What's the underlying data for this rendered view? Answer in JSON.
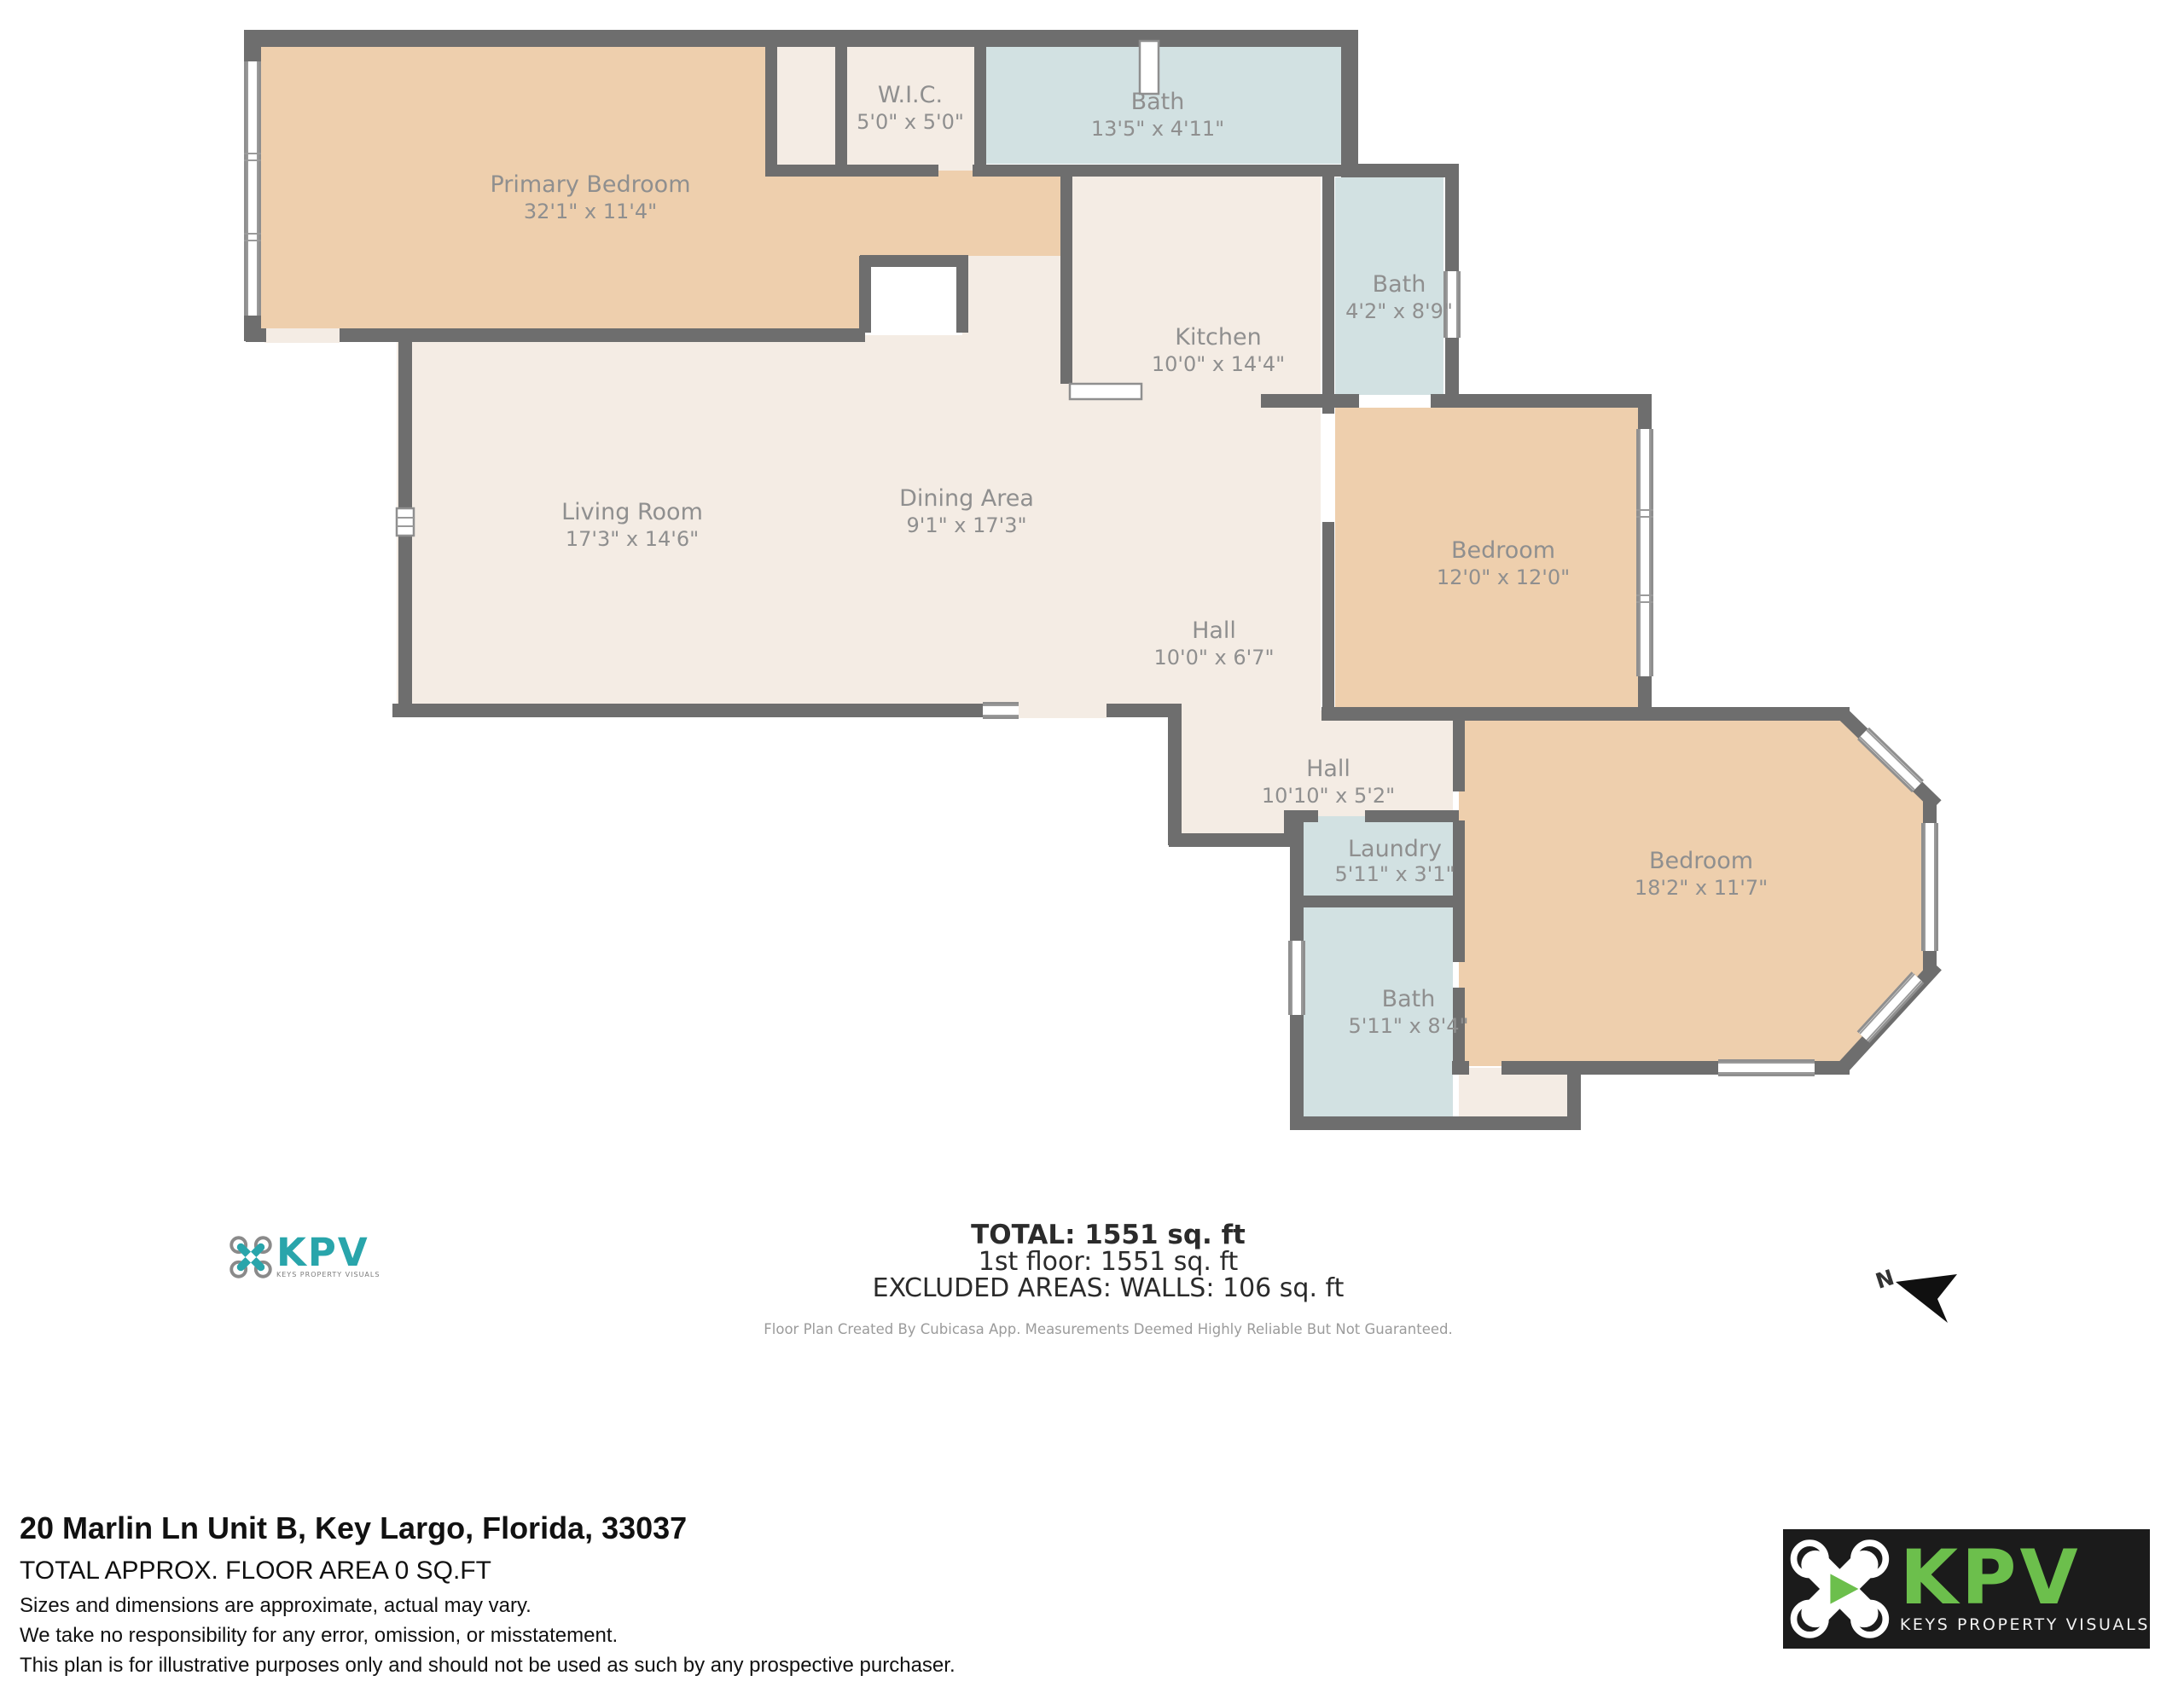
{
  "plan": {
    "rooms": [
      {
        "name": "Primary Bedroom",
        "dims": "32'1\" x 11'4\""
      },
      {
        "name": "W.I.C.",
        "dims": "5'0\" x 5'0\""
      },
      {
        "name": "Bath",
        "dims": "13'5\" x 4'11\""
      },
      {
        "name": "Bath",
        "dims": "4'2\" x 8'9\""
      },
      {
        "name": "Kitchen",
        "dims": "10'0\" x 14'4\""
      },
      {
        "name": "Dining Area",
        "dims": "9'1\" x 17'3\""
      },
      {
        "name": "Living Room",
        "dims": "17'3\" x 14'6\""
      },
      {
        "name": "Hall",
        "dims": "10'0\" x 6'7\""
      },
      {
        "name": "Bedroom",
        "dims": "12'0\" x 12'0\""
      },
      {
        "name": "Hall",
        "dims": "10'10\" x 5'2\""
      },
      {
        "name": "Laundry",
        "dims": "5'11\" x 3'1\""
      },
      {
        "name": "Bedroom",
        "dims": "18'2\" x 11'7\""
      },
      {
        "name": "Bath",
        "dims": "5'11\" x 8'4\""
      }
    ],
    "summary": {
      "total": "TOTAL: 1551 sq. ft",
      "floor": "1st floor: 1551 sq. ft",
      "excluded": "EXCLUDED AREAS: WALLS: 106 sq. ft",
      "note": "Floor Plan Created By Cubicasa App. Measurements Deemed Highly Reliable But Not Guaranteed."
    },
    "compass_label": "N"
  },
  "footer": {
    "address": "20 Marlin Ln Unit B, Key Largo, Florida, 33037",
    "area_line": "TOTAL APPROX. FLOOR AREA 0 SQ.FT",
    "disclaimers": [
      "Sizes and dimensions are approximate, actual may vary.",
      "We take no responsibility for any error, omission, or misstatement.",
      "This plan is for illustrative purposes only and should not be used as such by any prospective purchaser."
    ]
  },
  "branding": {
    "small_logo": {
      "text": "KPV",
      "tagline": "KEYS PROPERTY VISUALS"
    },
    "large_logo": {
      "text": "KPV",
      "tagline": "KEYS PROPERTY VISUALS"
    }
  },
  "colors": {
    "wall": "#6e6e6e",
    "bedroom_fill": "#eecfad",
    "living_fill": "#f4ece4",
    "bath_fill": "#d2e1e2",
    "label_text": "#8f8f8f",
    "logo_teal": "#29a5ab",
    "logo_green": "#6cbf4c",
    "logo_bg": "#1b1b1b"
  }
}
